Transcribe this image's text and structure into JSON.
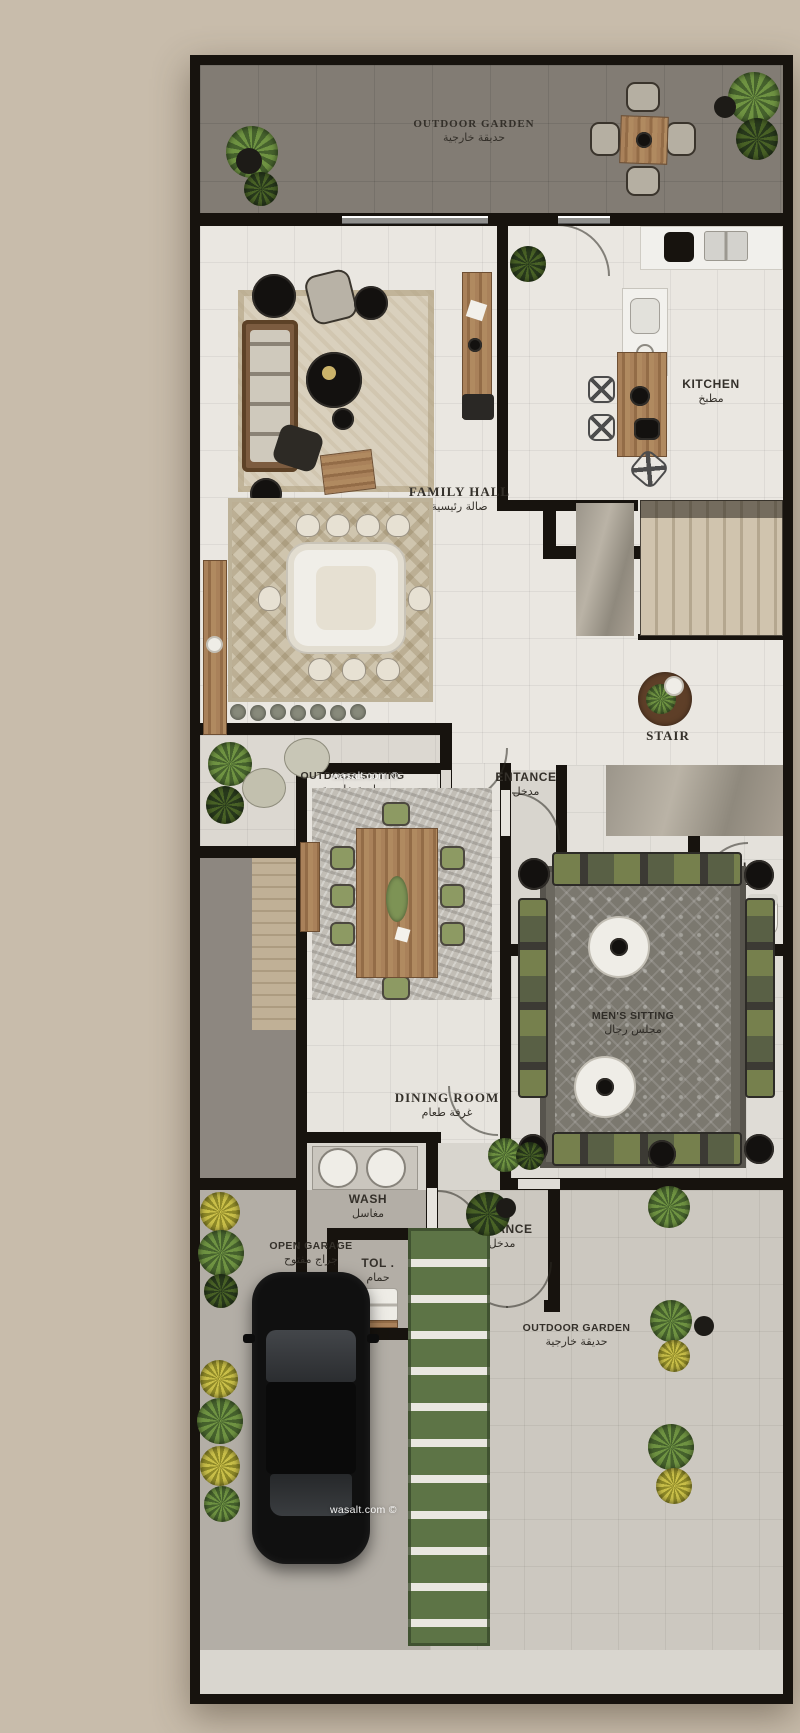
{
  "watermark": {
    "text": "wasalt.com ©"
  },
  "palette": {
    "background": "#c8bcab",
    "wall": "#17130e",
    "floor_light": "#eae7e1",
    "garden_top_floor": "#827c74",
    "corridor_floor": "#8d8780",
    "garage_floor": "#b3aea6",
    "garden_bottom_floor": "#ccc8c0",
    "plant_green": "#6f9342",
    "grass_path": "#5d7446",
    "wood": "#a9815a",
    "car": "#101010"
  },
  "rooms": [
    {
      "id": "outdoor-garden-top",
      "label": "OUTDOOR GARDEN",
      "label_ar": "حديقة خارجية"
    },
    {
      "id": "kitchen",
      "label": "KITCHEN",
      "label_ar": "مطبخ"
    },
    {
      "id": "family-hall",
      "label": "FAMILY HALL",
      "label_ar": "صالة رئيسية"
    },
    {
      "id": "stair",
      "label": "STAIR",
      "label_ar": ""
    },
    {
      "id": "outdoor-sitting",
      "label": "OUTDOOR SITTING",
      "label_ar": "جلسة خارجية"
    },
    {
      "id": "entrance-upper",
      "label": "ENTANCE",
      "label_ar": "مدخل"
    },
    {
      "id": "wash-upper",
      "label": "WASH",
      "label_ar": "مغاسل"
    },
    {
      "id": "toilet-upper",
      "label": "TOL .",
      "label_ar": "حمام"
    },
    {
      "id": "dining-room",
      "label": "DINING ROOM",
      "label_ar": "غرفة طعام"
    },
    {
      "id": "mens-sitting",
      "label": "MEN'S SITTING",
      "label_ar": "مجلس رجال"
    },
    {
      "id": "wash-lower",
      "label": "WASH",
      "label_ar": "مغاسل"
    },
    {
      "id": "entrance-lower",
      "label": "ENTANCE",
      "label_ar": "مدخل"
    },
    {
      "id": "toilet-lower",
      "label": "TOL .",
      "label_ar": "حمام"
    },
    {
      "id": "open-garage",
      "label": "OPEN GARAGE",
      "label_ar": "جراج مفتوح"
    },
    {
      "id": "outdoor-garden-bottom",
      "label": "OUTDOOR GARDEN",
      "label_ar": "حديقة خارجية"
    }
  ]
}
